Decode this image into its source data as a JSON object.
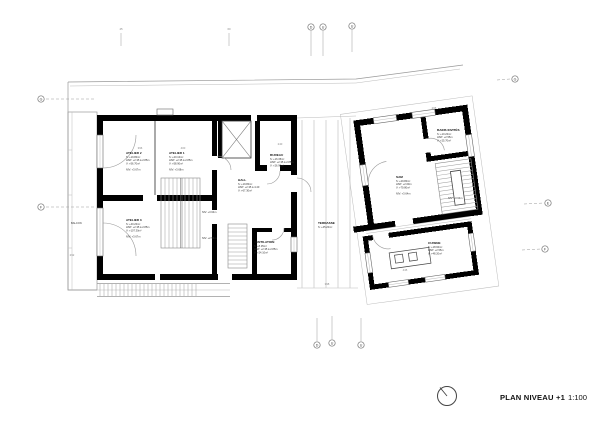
{
  "title": {
    "name": "PLAN NIVEAU +1",
    "scale": "1:100"
  },
  "rooms": {
    "atelier2": {
      "name": "ATELIER 2",
      "l1": "S: +19.80m²",
      "l2": "HSP: +2.35 à 2.85m",
      "l3": "V: +56.70m³",
      "niv": "NIV: +3.67m"
    },
    "atelier1": {
      "name": "ATELIER 1",
      "l1": "S: +20.10m²",
      "l2": "HSP: +2.35 à 2.85m",
      "l3": "V: +58.90m³",
      "niv": "NIV: +3.68m"
    },
    "atelier3": {
      "name": "ATELIER 3",
      "l1": "S: +40.20m²",
      "l2": "HSP: +2.35 à 2.85m",
      "l3": "V: +107.30m³",
      "niv": "NIV: +3.67m"
    },
    "bureau": {
      "name": "BUREAU",
      "l1": "S: +16.35m²",
      "l2": "HSP: +2.35 à 2.85m",
      "l3": "V: +26.90m³"
    },
    "hall": {
      "name": "HALL",
      "l1": "S: +19.80m²",
      "l2": "HSP: +2.35 à 4.40",
      "l3": "V: +67.30m³"
    },
    "ventilation": {
      "name": "VENTILATION",
      "l1": "S: +8.35m²",
      "l2": "HSP: +2.35 à 2.85m",
      "l3": "V: +24.10m³"
    },
    "terrasse": {
      "name": "TERRASSE",
      "l1": "S: +45.20m²"
    },
    "balcon": {
      "name": "BALCON"
    },
    "sam": {
      "name": "SAM",
      "l1": "S: +29.80m²",
      "l2": "HSP: +2.60m",
      "l3": "V: +79.80m³",
      "niv": "NIV: +3.64m"
    },
    "bains": {
      "name": "BAINS INVITÉS",
      "l1": "S: +10.20m²",
      "l2": "HSP: +2.55m",
      "l3": "V: +25.70m³"
    },
    "cuisine": {
      "name": "CUISINE",
      "l1": "S: +18.90m²",
      "l2": "HSP: +2.55m",
      "l3": "V: +48.20m³"
    }
  },
  "annotations": {
    "niv1": "NIV: +3.64m",
    "niv2": "NIV: +2.56m",
    "niv3": "NIV: +3.64m"
  },
  "grid": {
    "top": [
      "D",
      "U",
      "U"
    ],
    "bottom": [
      "D",
      "U",
      "U"
    ],
    "left": [
      "G",
      "F"
    ],
    "right": [
      "G",
      "E",
      "F"
    ]
  },
  "dims": {
    "t1": "45",
    "t2": "60",
    "d1": "396",
    "d2": "400",
    "d3": "240",
    "d4": "292",
    "d5": "398",
    "d6": "445",
    "d7": "265"
  },
  "colors": {
    "wall": "#000000",
    "thin_line": "#999999",
    "dim_text": "#888888",
    "label_text": "#111111"
  }
}
